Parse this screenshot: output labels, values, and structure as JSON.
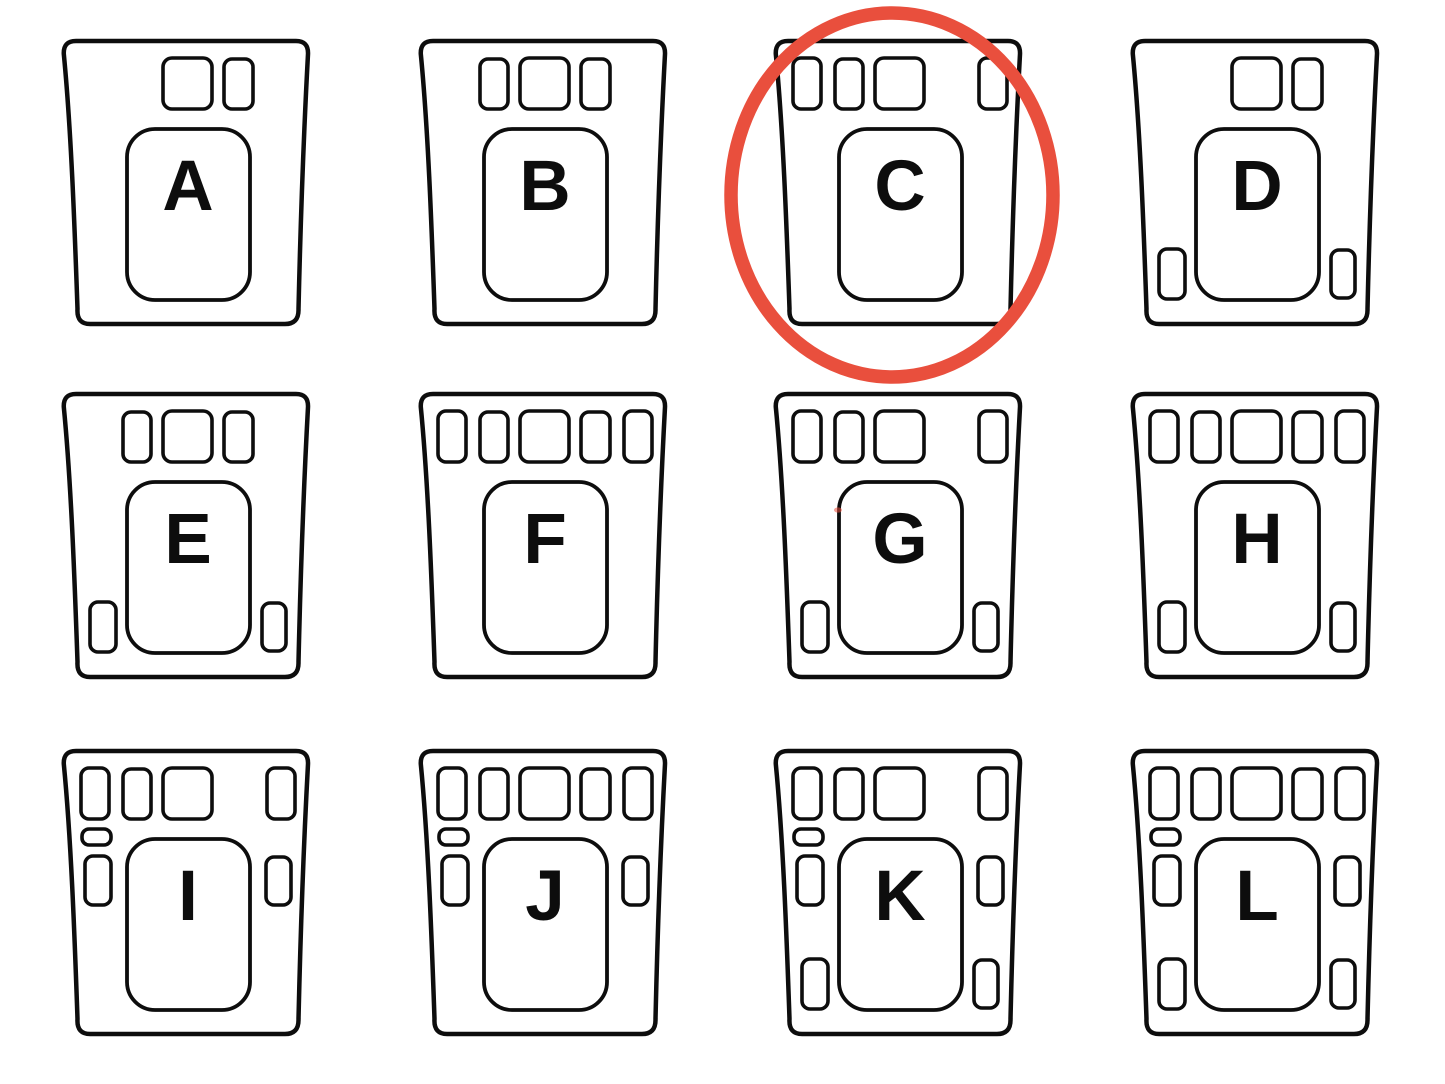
{
  "page": {
    "background_color": "#ffffff",
    "ink_color": "#0d0d0d"
  },
  "puzzle": {
    "kind": "multiple-choice panel diagram",
    "grid": {
      "rows": 3,
      "columns": 4
    },
    "options": [
      {
        "label": "A",
        "slots": [
          "top-square",
          "top-right"
        ]
      },
      {
        "label": "B",
        "slots": [
          "top-left",
          "top-square",
          "top-right"
        ]
      },
      {
        "label": "C",
        "slots": [
          "top-far-left",
          "top-left",
          "top-square",
          "top-far-right"
        ]
      },
      {
        "label": "D",
        "slots": [
          "top-square",
          "top-right",
          "bottom-left",
          "bottom-right"
        ]
      },
      {
        "label": "E",
        "slots": [
          "top-left",
          "top-square",
          "top-right",
          "bottom-left",
          "bottom-right"
        ]
      },
      {
        "label": "F",
        "slots": [
          "top-far-left",
          "top-left",
          "top-square",
          "top-right",
          "top-far-right"
        ]
      },
      {
        "label": "G",
        "slots": [
          "top-far-left",
          "top-left",
          "top-square",
          "top-far-right",
          "bottom-left",
          "bottom-right"
        ]
      },
      {
        "label": "H",
        "slots": [
          "top-far-left",
          "top-left",
          "top-square",
          "top-right",
          "top-far-right",
          "bottom-left",
          "bottom-right"
        ]
      },
      {
        "label": "I",
        "slots": [
          "top-far-left",
          "top-left",
          "top-square",
          "top-far-right",
          "left-pill",
          "left-mid",
          "right-mid"
        ]
      },
      {
        "label": "J",
        "slots": [
          "top-far-left",
          "top-left",
          "top-square",
          "top-right",
          "top-far-right",
          "left-pill",
          "left-mid",
          "right-mid"
        ]
      },
      {
        "label": "K",
        "slots": [
          "top-far-left",
          "top-left",
          "top-square",
          "top-far-right",
          "left-pill",
          "left-mid",
          "right-mid",
          "bottom-left",
          "bottom-right"
        ]
      },
      {
        "label": "L",
        "slots": [
          "top-far-left",
          "top-left",
          "top-square",
          "top-right",
          "top-far-right",
          "left-pill",
          "left-mid",
          "right-mid",
          "bottom-left",
          "bottom-right"
        ]
      }
    ],
    "annotation": {
      "circled_option": "C",
      "circle_color": "#E94F3D"
    },
    "artifacts": [
      {
        "type": "red-speck",
        "x": 838,
        "y": 510,
        "color": "#E94F3D"
      }
    ]
  }
}
